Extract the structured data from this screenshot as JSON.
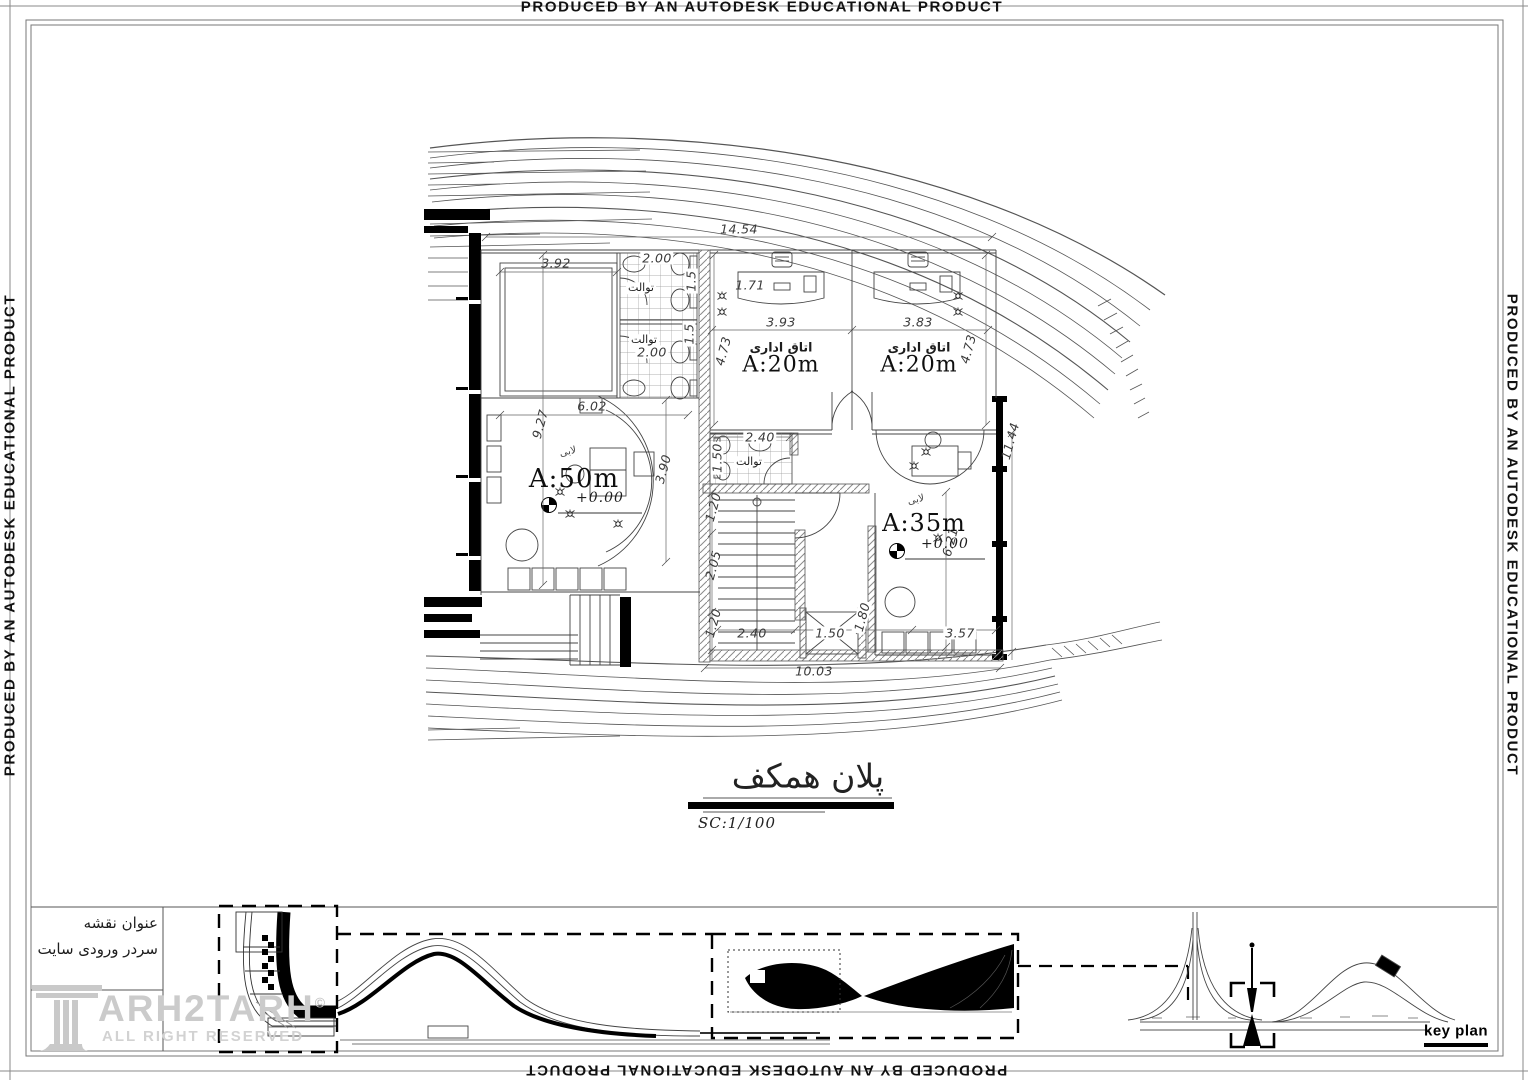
{
  "watermark": {
    "text": "PRODUCED BY AN AUTODESK EDUCATIONAL PRODUCT"
  },
  "plan": {
    "title": "پلان همکف",
    "scale": "SC:1/100",
    "rooms": {
      "lobby": {
        "tag": "لابی",
        "area": "A:50m",
        "level": "+0.00"
      },
      "office1": {
        "name": "اتاق اداری",
        "area": "A:20m"
      },
      "office2": {
        "name": "اتاق اداری",
        "area": "A:20m"
      },
      "hall": {
        "tag": "لابی",
        "area": "A:35m",
        "level": "+0.00"
      },
      "wc_top": {
        "name": "توالت"
      },
      "wc_bot": {
        "name": "توالت"
      },
      "wc_mid": {
        "name": "توالت"
      }
    },
    "dims": {
      "top_total": "14.54",
      "storage_w": "3.92",
      "wc_top_w": "2.00",
      "wc_top_h": "1.5",
      "wc_bot_w": "2.00",
      "wc_bot_h": "1.5",
      "entry": "1.71",
      "office1_w": "3.93",
      "office2_w": "3.83",
      "office1_d": "4.73",
      "office2_d": "4.73",
      "lobby_d": "9.27",
      "lobby_w": "6.02",
      "desk_d": "3.90",
      "wc_mid_w": "2.40",
      "wc_mid_h": "1.50",
      "corr_top": "1.20",
      "stair_flight": "2.05",
      "corr_bot": "1.20",
      "stair_w": "2.40",
      "elev_w": "1.50",
      "elev_d": "1.80",
      "hall_w": "3.57",
      "hall_d": "6.21",
      "right_total": "11.44",
      "bottom_total": "10.03"
    }
  },
  "titleblock": {
    "heading": "عنوان نقشه",
    "drawing_name": "سردر ورودی سایت",
    "brand": "ARH2TARH",
    "copyright": "©",
    "rights": "ALL RIGHT RESERVED",
    "keyplan": "key plan"
  }
}
